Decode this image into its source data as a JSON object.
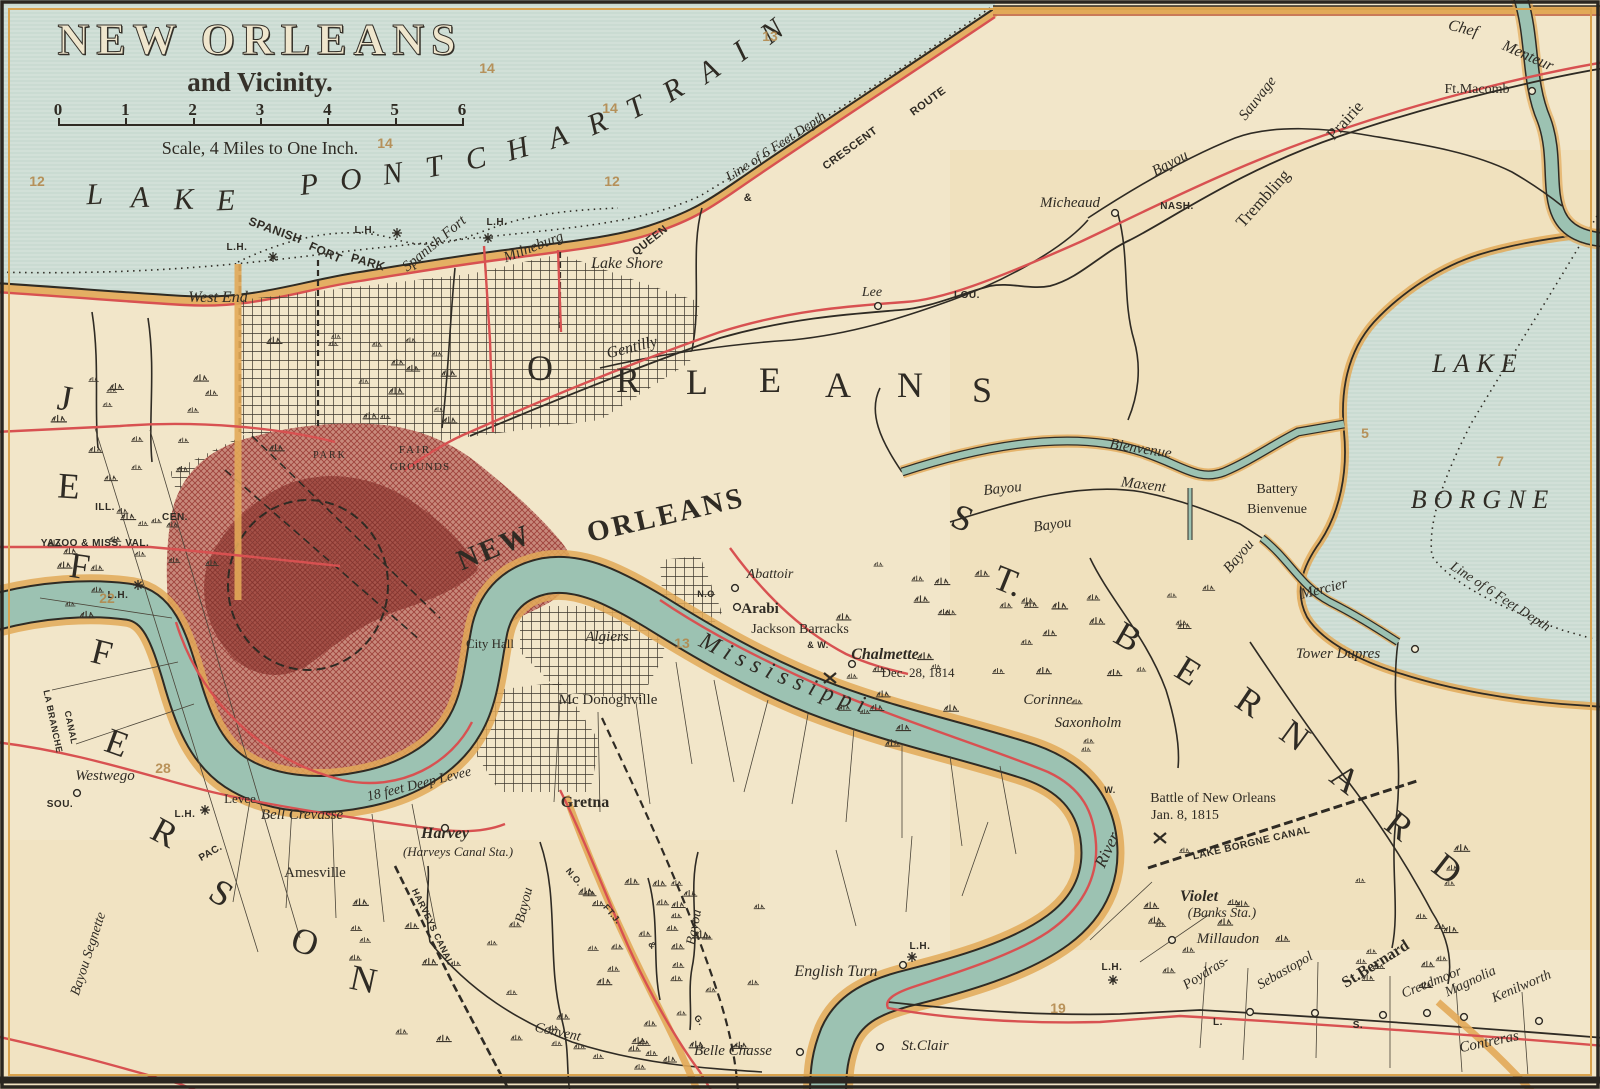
{
  "map": {
    "title": "NEW ORLEANS",
    "subtitle": "and Vicinity.",
    "scale_note": "Scale, 4 Miles to One Inch.",
    "scale_ticks": [
      "0",
      "1",
      "2",
      "3",
      "4",
      "5",
      "6"
    ],
    "river_label": "Mississippi",
    "colors": {
      "paper": "#f2e6c9",
      "lake": "#d5e3da",
      "river": "#9cc2b2",
      "rail_red": "#d85151",
      "road_orange": "#e2a958",
      "city_red": "#a2453e",
      "ink": "#2f2b24",
      "plate_tan": "#b3894d"
    },
    "labels": [
      {
        "t": "L",
        "x": 95,
        "y": 204,
        "s": 30,
        "i": 1,
        "r": -2
      },
      {
        "t": "A",
        "x": 140,
        "y": 207,
        "s": 30,
        "i": 1,
        "r": -2
      },
      {
        "t": "K",
        "x": 184,
        "y": 209,
        "s": 30,
        "i": 1,
        "r": -2
      },
      {
        "t": "E",
        "x": 226,
        "y": 210,
        "s": 30,
        "i": 1,
        "r": -2
      },
      {
        "t": "P",
        "x": 310,
        "y": 194,
        "s": 30,
        "i": 1,
        "r": -6
      },
      {
        "t": "O",
        "x": 352,
        "y": 189,
        "s": 30,
        "i": 1,
        "r": -7
      },
      {
        "t": "N",
        "x": 394,
        "y": 183,
        "s": 30,
        "i": 1,
        "r": -9
      },
      {
        "t": "T",
        "x": 436,
        "y": 176,
        "s": 30,
        "i": 1,
        "r": -11
      },
      {
        "t": "C",
        "x": 478,
        "y": 168,
        "s": 30,
        "i": 1,
        "r": -13
      },
      {
        "t": "H",
        "x": 520,
        "y": 158,
        "s": 30,
        "i": 1,
        "r": -16
      },
      {
        "t": "A",
        "x": 561,
        "y": 146,
        "s": 30,
        "i": 1,
        "r": -19
      },
      {
        "t": "R",
        "x": 601,
        "y": 132,
        "s": 30,
        "i": 1,
        "r": -23
      },
      {
        "t": "T",
        "x": 640,
        "y": 116,
        "s": 30,
        "i": 1,
        "r": -27
      },
      {
        "t": "R",
        "x": 678,
        "y": 98,
        "s": 30,
        "i": 1,
        "r": -31
      },
      {
        "t": "A",
        "x": 714,
        "y": 79,
        "s": 30,
        "i": 1,
        "r": -34
      },
      {
        "t": "I",
        "x": 746,
        "y": 59,
        "s": 30,
        "i": 1,
        "r": -36
      },
      {
        "t": "N",
        "x": 778,
        "y": 39,
        "s": 30,
        "i": 1,
        "r": -38
      },
      {
        "t": "LAKE",
        "x": 1478,
        "y": 372,
        "s": 26,
        "i": 1,
        "sp": 7
      },
      {
        "t": "BORGNE",
        "x": 1483,
        "y": 508,
        "s": 26,
        "i": 1,
        "sp": 7
      },
      {
        "t": "J",
        "x": 63,
        "y": 410,
        "s": 36,
        "r": 10
      },
      {
        "t": "E",
        "x": 68,
        "y": 498,
        "s": 36,
        "r": 4
      },
      {
        "t": "F",
        "x": 78,
        "y": 578,
        "s": 36,
        "r": 8
      },
      {
        "t": "F",
        "x": 99,
        "y": 664,
        "s": 36,
        "r": 14
      },
      {
        "t": "E",
        "x": 113,
        "y": 754,
        "s": 36,
        "r": 20
      },
      {
        "t": "R",
        "x": 159,
        "y": 843,
        "s": 36,
        "r": 28
      },
      {
        "t": "S",
        "x": 215,
        "y": 903,
        "s": 36,
        "r": 32
      },
      {
        "t": "O",
        "x": 301,
        "y": 953,
        "s": 36,
        "r": 20
      },
      {
        "t": "N",
        "x": 361,
        "y": 991,
        "s": 36,
        "r": 12
      },
      {
        "t": "O",
        "x": 540,
        "y": 380,
        "s": 36
      },
      {
        "t": "R",
        "x": 628,
        "y": 392,
        "s": 36
      },
      {
        "t": "L",
        "x": 697,
        "y": 394,
        "s": 36
      },
      {
        "t": "E",
        "x": 770,
        "y": 392,
        "s": 36
      },
      {
        "t": "A",
        "x": 838,
        "y": 397,
        "s": 36
      },
      {
        "t": "N",
        "x": 910,
        "y": 397,
        "s": 36
      },
      {
        "t": "S",
        "x": 982,
        "y": 402,
        "s": 36
      },
      {
        "t": "S",
        "x": 958,
        "y": 529,
        "s": 36,
        "r": 22
      },
      {
        "t": "T.",
        "x": 1004,
        "y": 592,
        "s": 36,
        "r": 22
      },
      {
        "t": "B",
        "x": 1122,
        "y": 647,
        "s": 36,
        "r": 30
      },
      {
        "t": "E",
        "x": 1182,
        "y": 681,
        "s": 36,
        "r": 32
      },
      {
        "t": "R",
        "x": 1243,
        "y": 712,
        "s": 36,
        "r": 34
      },
      {
        "t": "N",
        "x": 1288,
        "y": 745,
        "s": 36,
        "r": 36
      },
      {
        "t": "A",
        "x": 1338,
        "y": 788,
        "s": 36,
        "r": 38
      },
      {
        "t": "R",
        "x": 1392,
        "y": 835,
        "s": 36,
        "r": 38
      },
      {
        "t": "D",
        "x": 1440,
        "y": 878,
        "s": 36,
        "r": 38
      },
      {
        "t": "NEW",
        "x": 498,
        "y": 556,
        "s": 29,
        "b": 1,
        "r": -22,
        "sp": 3
      },
      {
        "t": "ORLEANS",
        "x": 668,
        "y": 524,
        "s": 29,
        "b": 1,
        "r": -13,
        "sp": 3
      },
      {
        "t": "West End",
        "x": 218,
        "y": 302,
        "s": 16,
        "i": 1
      },
      {
        "t": "SPANISH",
        "x": 274,
        "y": 234,
        "s": 12,
        "r": 20,
        "f": "sans"
      },
      {
        "t": "FORT",
        "x": 324,
        "y": 256,
        "s": 12,
        "r": 24,
        "f": "sans"
      },
      {
        "t": "PARK",
        "x": 367,
        "y": 266,
        "s": 12,
        "r": 16,
        "f": "sans"
      },
      {
        "t": "L.H.",
        "x": 237,
        "y": 250,
        "s": 10,
        "f": "sans"
      },
      {
        "t": "L.H.",
        "x": 365,
        "y": 233,
        "s": 10,
        "f": "sans"
      },
      {
        "t": "L.H.",
        "x": 497,
        "y": 225,
        "s": 10,
        "f": "sans"
      },
      {
        "t": "L.H.",
        "x": 118,
        "y": 598,
        "s": 10,
        "f": "sans"
      },
      {
        "t": "L.H.",
        "x": 185,
        "y": 817,
        "s": 10,
        "f": "sans"
      },
      {
        "t": "L.H.",
        "x": 920,
        "y": 949,
        "s": 10,
        "f": "sans"
      },
      {
        "t": "L.H.",
        "x": 1112,
        "y": 970,
        "s": 10,
        "f": "sans"
      },
      {
        "t": "Spanish Fort",
        "x": 437,
        "y": 247,
        "s": 15,
        "i": 1,
        "r": -40
      },
      {
        "t": "Milneburg",
        "x": 535,
        "y": 251,
        "s": 15,
        "i": 1,
        "r": -21
      },
      {
        "t": "Lake Shore",
        "x": 627,
        "y": 268,
        "s": 16,
        "i": 1
      },
      {
        "t": "Gentilly",
        "x": 633,
        "y": 352,
        "s": 16,
        "i": 1,
        "r": -14
      },
      {
        "t": "QUEEN",
        "x": 652,
        "y": 243,
        "s": 11,
        "f": "sans",
        "r": -38
      },
      {
        "t": "&",
        "x": 748,
        "y": 201,
        "s": 11,
        "f": "sans"
      },
      {
        "t": "CRESCENT",
        "x": 852,
        "y": 151,
        "s": 11,
        "f": "sans",
        "r": -36
      },
      {
        "t": "ROUTE",
        "x": 930,
        "y": 104,
        "s": 11,
        "f": "sans",
        "r": -36
      },
      {
        "t": "Line of 6 Feet Depth",
        "x": 778,
        "y": 150,
        "s": 14,
        "i": 1,
        "r": -33
      },
      {
        "t": "Line of 6 Feet Depth",
        "x": 1498,
        "y": 600,
        "s": 14,
        "i": 1,
        "r": 33
      },
      {
        "t": "Micheaud",
        "x": 1070,
        "y": 207,
        "s": 15,
        "i": 1
      },
      {
        "t": "NASH.",
        "x": 1177,
        "y": 209,
        "s": 10,
        "f": "sans"
      },
      {
        "t": "LOU.",
        "x": 967,
        "y": 298,
        "s": 10,
        "f": "sans"
      },
      {
        "t": "Lee",
        "x": 872,
        "y": 296,
        "s": 14,
        "i": 1
      },
      {
        "t": "Bayou",
        "x": 1172,
        "y": 167,
        "s": 15,
        "i": 1,
        "r": -28
      },
      {
        "t": "Sauvage",
        "x": 1261,
        "y": 101,
        "s": 15,
        "i": 1,
        "r": -52
      },
      {
        "t": "Trembling",
        "x": 1267,
        "y": 202,
        "s": 17,
        "r": -48
      },
      {
        "t": "Prairie",
        "x": 1349,
        "y": 124,
        "s": 17,
        "r": -48
      },
      {
        "t": "Chef",
        "x": 1462,
        "y": 33,
        "s": 16,
        "i": 1,
        "r": 14
      },
      {
        "t": "Menteur",
        "x": 1526,
        "y": 60,
        "s": 16,
        "i": 1,
        "r": 24
      },
      {
        "t": "Ft.Macomb",
        "x": 1477,
        "y": 93,
        "s": 14
      },
      {
        "t": "Bayou",
        "x": 1003,
        "y": 493,
        "s": 15,
        "i": 1,
        "r": -6
      },
      {
        "t": "Bienvenue",
        "x": 1140,
        "y": 453,
        "s": 15,
        "i": 1,
        "r": 9
      },
      {
        "t": "Bayou",
        "x": 1053,
        "y": 529,
        "s": 15,
        "i": 1,
        "r": -8
      },
      {
        "t": "Maxent",
        "x": 1143,
        "y": 489,
        "s": 15,
        "i": 1,
        "r": 7
      },
      {
        "t": "Battery",
        "x": 1277,
        "y": 493,
        "s": 14
      },
      {
        "t": "Bienvenue",
        "x": 1277,
        "y": 513,
        "s": 14
      },
      {
        "t": "Bayou",
        "x": 1242,
        "y": 559,
        "s": 15,
        "i": 1,
        "r": -50
      },
      {
        "t": "Mercier",
        "x": 1325,
        "y": 593,
        "s": 15,
        "i": 1,
        "r": -14
      },
      {
        "t": "Tower Dupres",
        "x": 1338,
        "y": 658,
        "s": 15,
        "i": 1
      },
      {
        "t": "Corinne",
        "x": 1048,
        "y": 704,
        "s": 15,
        "i": 1
      },
      {
        "t": "Saxonholm",
        "x": 1088,
        "y": 727,
        "s": 15,
        "i": 1
      },
      {
        "t": "W.",
        "x": 1110,
        "y": 793,
        "s": 9,
        "f": "sans"
      },
      {
        "t": "Battle of New Orleans",
        "x": 1213,
        "y": 802,
        "s": 14
      },
      {
        "t": "Jan. 8, 1815",
        "x": 1185,
        "y": 819,
        "s": 14
      },
      {
        "t": "LAKE BORGNE CANAL",
        "x": 1252,
        "y": 846,
        "s": 10,
        "f": "sans",
        "r": -13
      },
      {
        "t": "Violet",
        "x": 1199,
        "y": 901,
        "s": 16,
        "i": 1,
        "b": 1
      },
      {
        "t": "(Banks Sta.)",
        "x": 1222,
        "y": 917,
        "s": 14,
        "i": 1
      },
      {
        "t": "Millaudon",
        "x": 1228,
        "y": 943,
        "s": 15,
        "i": 1
      },
      {
        "t": "Poydras-",
        "x": 1208,
        "y": 976,
        "s": 14,
        "i": 1,
        "r": -32
      },
      {
        "t": "Sebastopol",
        "x": 1287,
        "y": 974,
        "s": 14,
        "i": 1,
        "r": -30
      },
      {
        "t": "St.Bernard",
        "x": 1378,
        "y": 968,
        "s": 16,
        "b": 1,
        "r": -32
      },
      {
        "t": "Creedmoor",
        "x": 1433,
        "y": 986,
        "s": 14,
        "i": 1,
        "r": -22
      },
      {
        "t": "Magnolia",
        "x": 1472,
        "y": 985,
        "s": 14,
        "i": 1,
        "r": -25
      },
      {
        "t": "Kenilworth",
        "x": 1523,
        "y": 990,
        "s": 14,
        "i": 1,
        "r": -23
      },
      {
        "t": "Contreras",
        "x": 1490,
        "y": 1046,
        "s": 15,
        "i": 1,
        "r": -12
      },
      {
        "t": "L.",
        "x": 1218,
        "y": 1025,
        "s": 10,
        "f": "sans"
      },
      {
        "t": "S.",
        "x": 1358,
        "y": 1028,
        "s": 10,
        "f": "sans"
      },
      {
        "t": "River",
        "x": 1112,
        "y": 852,
        "s": 17,
        "i": 1,
        "r": -65
      },
      {
        "t": "English Turn",
        "x": 836,
        "y": 976,
        "s": 16,
        "i": 1
      },
      {
        "t": "St.Clair",
        "x": 925,
        "y": 1050,
        "s": 15,
        "i": 1
      },
      {
        "t": "Belle Chasse",
        "x": 733,
        "y": 1055,
        "s": 15,
        "i": 1
      },
      {
        "t": "Gretna",
        "x": 585,
        "y": 807,
        "s": 16,
        "b": 1
      },
      {
        "t": "Harvey",
        "x": 445,
        "y": 838,
        "s": 16,
        "b": 1,
        "i": 1
      },
      {
        "t": "(Harveys Canal Sta.)",
        "x": 458,
        "y": 856,
        "s": 13,
        "i": 1
      },
      {
        "t": "Amesville",
        "x": 315,
        "y": 877,
        "s": 15
      },
      {
        "t": "Westwego",
        "x": 105,
        "y": 780,
        "s": 15,
        "i": 1
      },
      {
        "t": "SOU.",
        "x": 60,
        "y": 807,
        "s": 10,
        "f": "sans"
      },
      {
        "t": "PAC.",
        "x": 212,
        "y": 855,
        "s": 10,
        "f": "sans",
        "r": -30
      },
      {
        "t": "Levee",
        "x": 240,
        "y": 803,
        "s": 13
      },
      {
        "t": "Bell Crevasse",
        "x": 302,
        "y": 819,
        "s": 15,
        "i": 1
      },
      {
        "t": "18 feet Deep Levee",
        "x": 420,
        "y": 788,
        "s": 14,
        "i": 1,
        "r": -14
      },
      {
        "t": "LA BRANCHE",
        "x": 50,
        "y": 722,
        "s": 9,
        "f": "sans",
        "r": 78
      },
      {
        "t": "CANAL",
        "x": 68,
        "y": 728,
        "s": 9,
        "f": "sans",
        "r": 78
      },
      {
        "t": "Bayou Segnette",
        "x": 92,
        "y": 955,
        "s": 14,
        "i": 1,
        "r": -72
      },
      {
        "t": "HARVEYS CANAL",
        "x": 430,
        "y": 928,
        "s": 9,
        "f": "sans",
        "r": 64
      },
      {
        "t": "Bayou",
        "x": 528,
        "y": 906,
        "s": 14,
        "i": 1,
        "r": -76
      },
      {
        "t": "Bayou",
        "x": 698,
        "y": 928,
        "s": 14,
        "i": 1,
        "r": -80
      },
      {
        "t": "Convent",
        "x": 557,
        "y": 1036,
        "s": 14,
        "i": 1,
        "r": 12
      },
      {
        "t": "N.O.",
        "x": 572,
        "y": 879,
        "s": 9,
        "f": "sans",
        "r": 50
      },
      {
        "t": "FT.J.",
        "x": 610,
        "y": 916,
        "s": 9,
        "f": "sans",
        "r": 50
      },
      {
        "t": "&",
        "x": 650,
        "y": 947,
        "s": 9,
        "f": "sans",
        "r": 50
      },
      {
        "t": "G.",
        "x": 697,
        "y": 1022,
        "s": 9,
        "f": "sans",
        "r": 50
      },
      {
        "t": "Mc Donoghville",
        "x": 608,
        "y": 704,
        "s": 15
      },
      {
        "t": "Algiers",
        "x": 607,
        "y": 641,
        "s": 15,
        "i": 1
      },
      {
        "t": "City Hall",
        "x": 490,
        "y": 648,
        "s": 13
      },
      {
        "t": "Abattoir",
        "x": 770,
        "y": 578,
        "s": 14,
        "i": 1
      },
      {
        "t": "N.O",
        "x": 706,
        "y": 597,
        "s": 9,
        "f": "sans"
      },
      {
        "t": "Arabi",
        "x": 760,
        "y": 613,
        "s": 15,
        "b": 1
      },
      {
        "t": "Jackson Barracks",
        "x": 800,
        "y": 633,
        "s": 14
      },
      {
        "t": "& W.",
        "x": 818,
        "y": 648,
        "s": 9,
        "f": "sans"
      },
      {
        "t": "Chalmette",
        "x": 885,
        "y": 659,
        "s": 16,
        "b": 1,
        "i": 1
      },
      {
        "t": "Dec. 28, 1814",
        "x": 918,
        "y": 677,
        "s": 13
      },
      {
        "t": "FAIR",
        "x": 415,
        "y": 453,
        "s": 11,
        "sp": 2
      },
      {
        "t": "GROUNDS",
        "x": 420,
        "y": 470,
        "s": 11,
        "sp": 1
      },
      {
        "t": "PARK",
        "x": 330,
        "y": 458,
        "s": 10,
        "sp": 2
      },
      {
        "t": "ILL.",
        "x": 105,
        "y": 510,
        "s": 10,
        "f": "sans"
      },
      {
        "t": "CEN.",
        "x": 175,
        "y": 520,
        "s": 10,
        "f": "sans"
      },
      {
        "t": "YAZOO & MISS. VAL.",
        "x": 95,
        "y": 546,
        "s": 10,
        "f": "sans"
      }
    ],
    "plate_numbers": [
      {
        "t": "12",
        "x": 37,
        "y": 186
      },
      {
        "t": "14",
        "x": 385,
        "y": 148
      },
      {
        "t": "14",
        "x": 487,
        "y": 73
      },
      {
        "t": "14",
        "x": 610,
        "y": 113
      },
      {
        "t": "12",
        "x": 612,
        "y": 186
      },
      {
        "t": "13",
        "x": 770,
        "y": 41
      },
      {
        "t": "5",
        "x": 1365,
        "y": 438
      },
      {
        "t": "7",
        "x": 1500,
        "y": 466
      },
      {
        "t": "22",
        "x": 107,
        "y": 603
      },
      {
        "t": "13",
        "x": 682,
        "y": 648
      },
      {
        "t": "28",
        "x": 163,
        "y": 773
      },
      {
        "t": "19",
        "x": 1058,
        "y": 1013
      }
    ],
    "stations": [
      [
        878,
        306
      ],
      [
        1115,
        213
      ],
      [
        1532,
        91
      ],
      [
        1415,
        649
      ],
      [
        1172,
        940
      ],
      [
        737,
        607
      ],
      [
        852,
        664
      ],
      [
        880,
        1047
      ],
      [
        800,
        1052
      ],
      [
        903,
        965
      ],
      [
        77,
        793
      ],
      [
        1250,
        1012
      ],
      [
        1315,
        1013
      ],
      [
        1383,
        1015
      ],
      [
        1427,
        1013
      ],
      [
        1464,
        1017
      ],
      [
        1539,
        1021
      ],
      [
        445,
        828
      ],
      [
        735,
        588
      ]
    ],
    "lighthouses": [
      [
        273,
        257
      ],
      [
        397,
        233
      ],
      [
        488,
        238
      ],
      [
        138,
        585
      ],
      [
        205,
        810
      ],
      [
        912,
        957
      ],
      [
        1113,
        980
      ]
    ],
    "battle_marks": [
      [
        830,
        678
      ],
      [
        1160,
        838
      ]
    ]
  }
}
